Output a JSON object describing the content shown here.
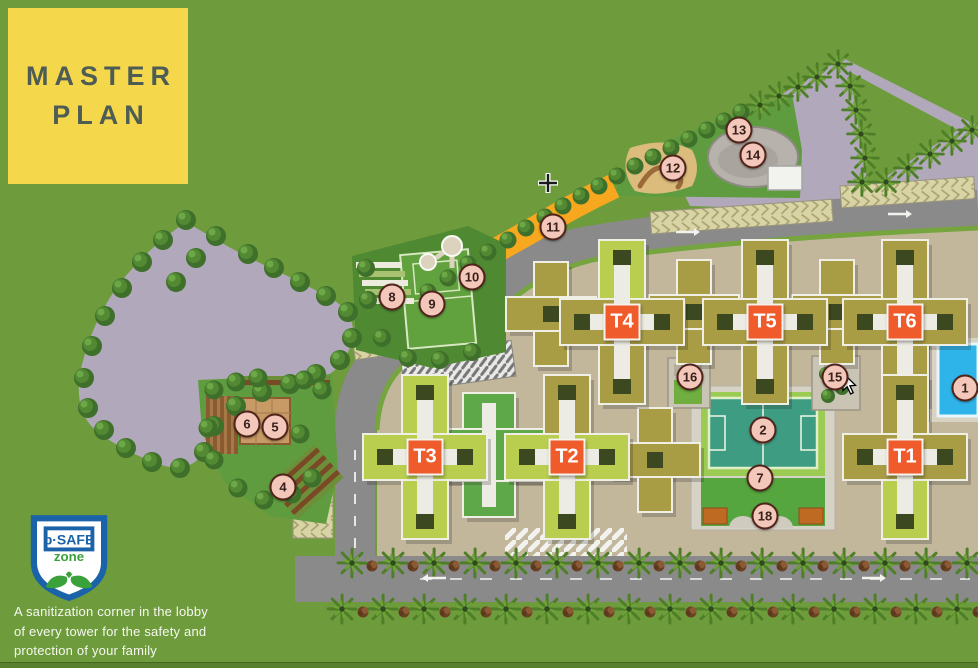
{
  "title": {
    "lines": [
      "MASTER",
      "PLAN"
    ]
  },
  "safety_badge": {
    "brand": "b·SAFE",
    "zone_label": "zone",
    "caption_lines": [
      "A sanitization corner in the lobby",
      "of  every tower for the safety and",
      "protection of your family"
    ]
  },
  "map": {
    "tower_labels": [
      {
        "label": "T4",
        "x": 622,
        "y": 322
      },
      {
        "label": "T5",
        "x": 765,
        "y": 322
      },
      {
        "label": "T6",
        "x": 905,
        "y": 322
      },
      {
        "label": "T3",
        "x": 425,
        "y": 457
      },
      {
        "label": "T2",
        "x": 567,
        "y": 457
      },
      {
        "label": "T1",
        "x": 905,
        "y": 457
      }
    ],
    "markers": [
      {
        "num": "1",
        "x": 965,
        "y": 388
      },
      {
        "num": "2",
        "x": 763,
        "y": 430
      },
      {
        "num": "4",
        "x": 283,
        "y": 487
      },
      {
        "num": "5",
        "x": 275,
        "y": 427
      },
      {
        "num": "6",
        "x": 247,
        "y": 424
      },
      {
        "num": "7",
        "x": 760,
        "y": 478
      },
      {
        "num": "8",
        "x": 392,
        "y": 297
      },
      {
        "num": "9",
        "x": 432,
        "y": 304
      },
      {
        "num": "10",
        "x": 472,
        "y": 277
      },
      {
        "num": "11",
        "x": 553,
        "y": 227
      },
      {
        "num": "12",
        "x": 673,
        "y": 168
      },
      {
        "num": "13",
        "x": 739,
        "y": 130
      },
      {
        "num": "14",
        "x": 753,
        "y": 155
      },
      {
        "num": "15",
        "x": 835,
        "y": 377
      },
      {
        "num": "16",
        "x": 690,
        "y": 377
      },
      {
        "num": "18",
        "x": 765,
        "y": 516
      }
    ],
    "colors": {
      "grass": "#6E9C3C",
      "panel_yellow": "#F5D74B",
      "tower_label_orange": "#EF5B2B",
      "marker_pink": "#F4C7BB",
      "khaki_building": "#A89C45",
      "lime_building": "#B9CE4E",
      "green_building": "#5FA84A",
      "road_gray": "#8A8A8A",
      "parcel_purple": "#B1A9BB",
      "jog_track_orange": "#F7A81F",
      "pool_blue": "#2FB4E9",
      "sports_court_teal": "#3E9C82",
      "badge_blue": "#1B63A8",
      "badge_green": "#3BA13B"
    }
  }
}
